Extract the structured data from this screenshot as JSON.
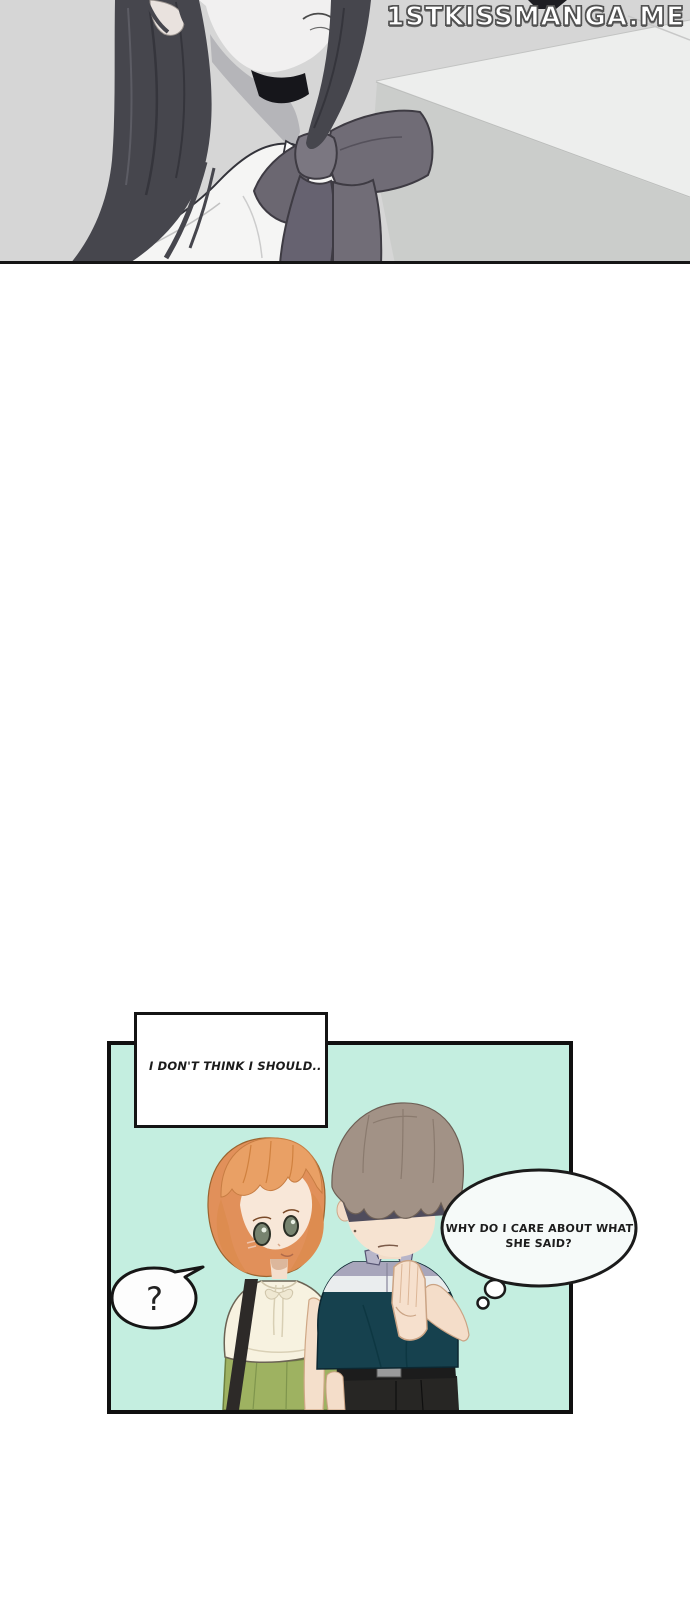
{
  "top_panel": {
    "watermark": "1STKISSMANGA.ME",
    "description_colors": {
      "background_gray": "#d6d6d6",
      "light_diagonal_band": "#edeeed",
      "lower_gray": "#cbcdcb",
      "hair_dark": "#46464d",
      "bow_gray": "#706c76",
      "shirt_white": "#f5f5f4"
    }
  },
  "bottom_panel": {
    "caption": "I DON'T THINK I SHOULD..",
    "question": "?",
    "thought": {
      "line1": "WHY DO I CARE ABOUT WHAT",
      "line2": "SHE SAID?"
    },
    "colors": {
      "panel_background_mint": "#c4eee0",
      "panel_border": "#101010",
      "girl_hair_orange": "#e9a065",
      "girl_blouse_cream": "#f7f2e0",
      "girl_skirt_green": "#9eb261",
      "boy_hair_gray_brown": "#a29286",
      "boy_shirt_lavender": "#a8a6bb",
      "boy_shirt_stripe_white": "#eaedee",
      "boy_shirt_dark_teal": "#16414e",
      "boy_pants_black": "#272624"
    }
  }
}
